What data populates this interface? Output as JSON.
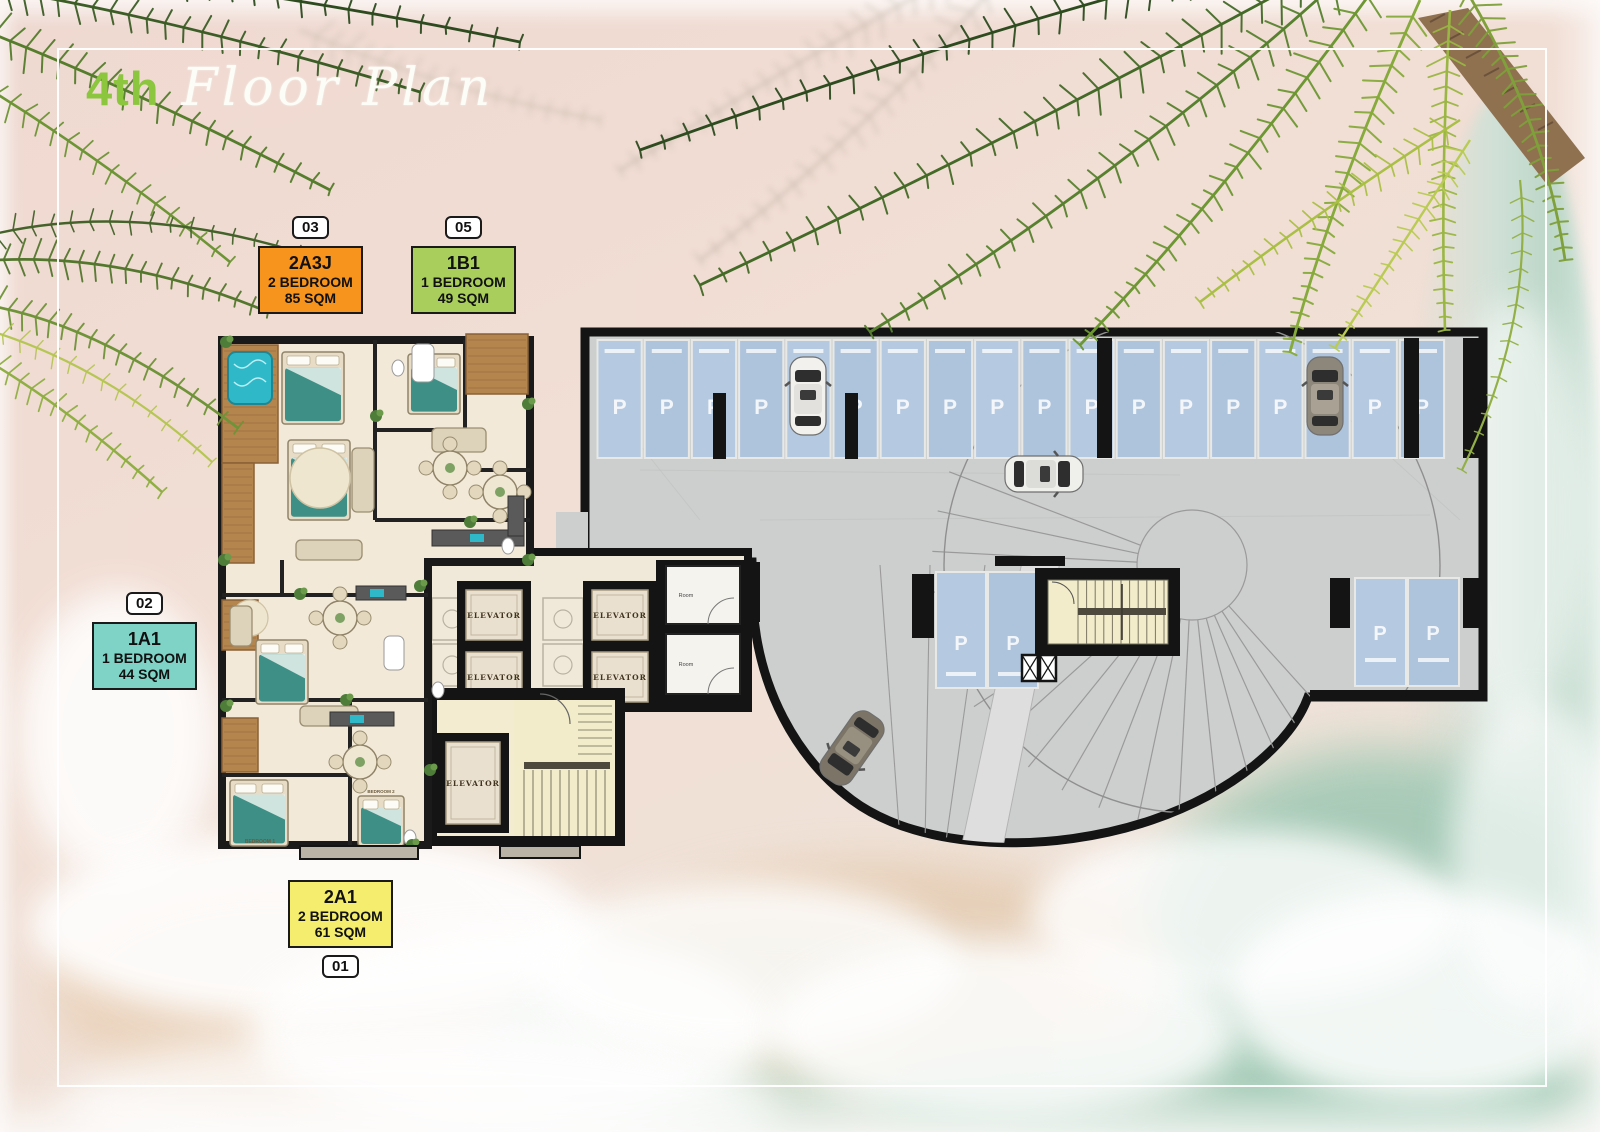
{
  "title": {
    "floor_ordinal": "4th",
    "plan_script": "Floor Plan"
  },
  "units": [
    {
      "badge": "03",
      "code": "2A3J",
      "type": "2 BEDROOM",
      "area": "85 SQM",
      "color": "#F7941E"
    },
    {
      "badge": "05",
      "code": "1B1",
      "type": "1 BEDROOM",
      "area": "49 SQM",
      "color": "#A9CE5C"
    },
    {
      "badge": "02",
      "code": "1A1",
      "type": "1 BEDROOM",
      "area": "44 SQM",
      "color": "#7ED3C6"
    },
    {
      "badge": "01",
      "code": "2A1",
      "type": "2 BEDROOM",
      "area": "61 SQM",
      "color": "#F4ED6E"
    }
  ],
  "plan": {
    "parking_stall_label": "P",
    "elevator_label": "ELEVATOR",
    "utility_room_labels": [
      "Room",
      "Room"
    ],
    "bedroom_labels": [
      "BEDROOM 1",
      "BEDROOM 2"
    ],
    "top_parking_stall_count": 18,
    "mid_parking_stall_count": 2,
    "right_parking_stall_count": 2,
    "elevator_count": 5,
    "car_count": 4
  },
  "colors": {
    "accent_green": "#8CC63E",
    "parking_blue": "#B3C7DE",
    "wall_black": "#161616",
    "garage_floor": "#CDCFCE",
    "apartment_floor": "#F2E9D8",
    "stair_cream": "#F2ECCA",
    "wood": "#B5854E",
    "pool_teal": "#2FB9C8",
    "bed_teal": "#3E8F85"
  }
}
